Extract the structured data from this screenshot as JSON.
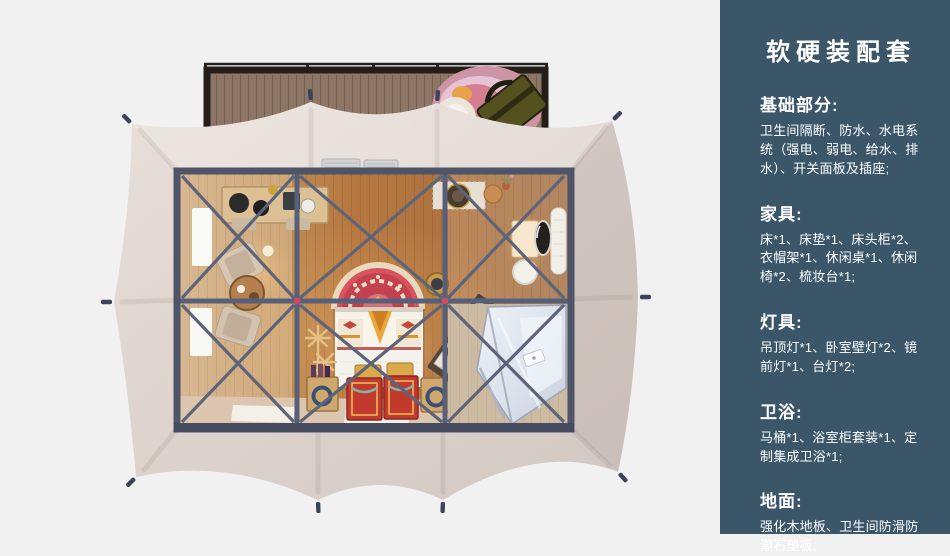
{
  "panel": {
    "title": "软硬装配套",
    "bg_color": "#3a5668",
    "text_color": "#ffffff",
    "sections": [
      {
        "heading": "基础部分:",
        "body": "卫生间隔断、防水、水电系统（强电、弱电、给水、排水）、开关面板及插座;"
      },
      {
        "heading": "家具:",
        "body": "床*1、床垫*1、床头柜*2、衣帽架*1、休闲桌*1、休闲椅*2、梳妆台*1;"
      },
      {
        "heading": "灯具:",
        "body": "吊顶灯*1、卧室壁灯*2、镜前灯*1、台灯*2;"
      },
      {
        "heading": "卫浴:",
        "body": "马桶*1、浴室柜套装*1、定制集成卫浴*1;"
      },
      {
        "heading": "地面:",
        "body": "强化木地板、卫生间防滑防潮石塑板;"
      }
    ]
  },
  "illustration": {
    "colors": {
      "page_background": "#f1f1f2",
      "tent_fabric": "#ded4cd",
      "steel_frame": "#586079",
      "wood_floor": "#b5773f",
      "deck_wood": "#8d7666",
      "rug_red": "#c4414f",
      "connector_red": "#d5485f"
    }
  }
}
